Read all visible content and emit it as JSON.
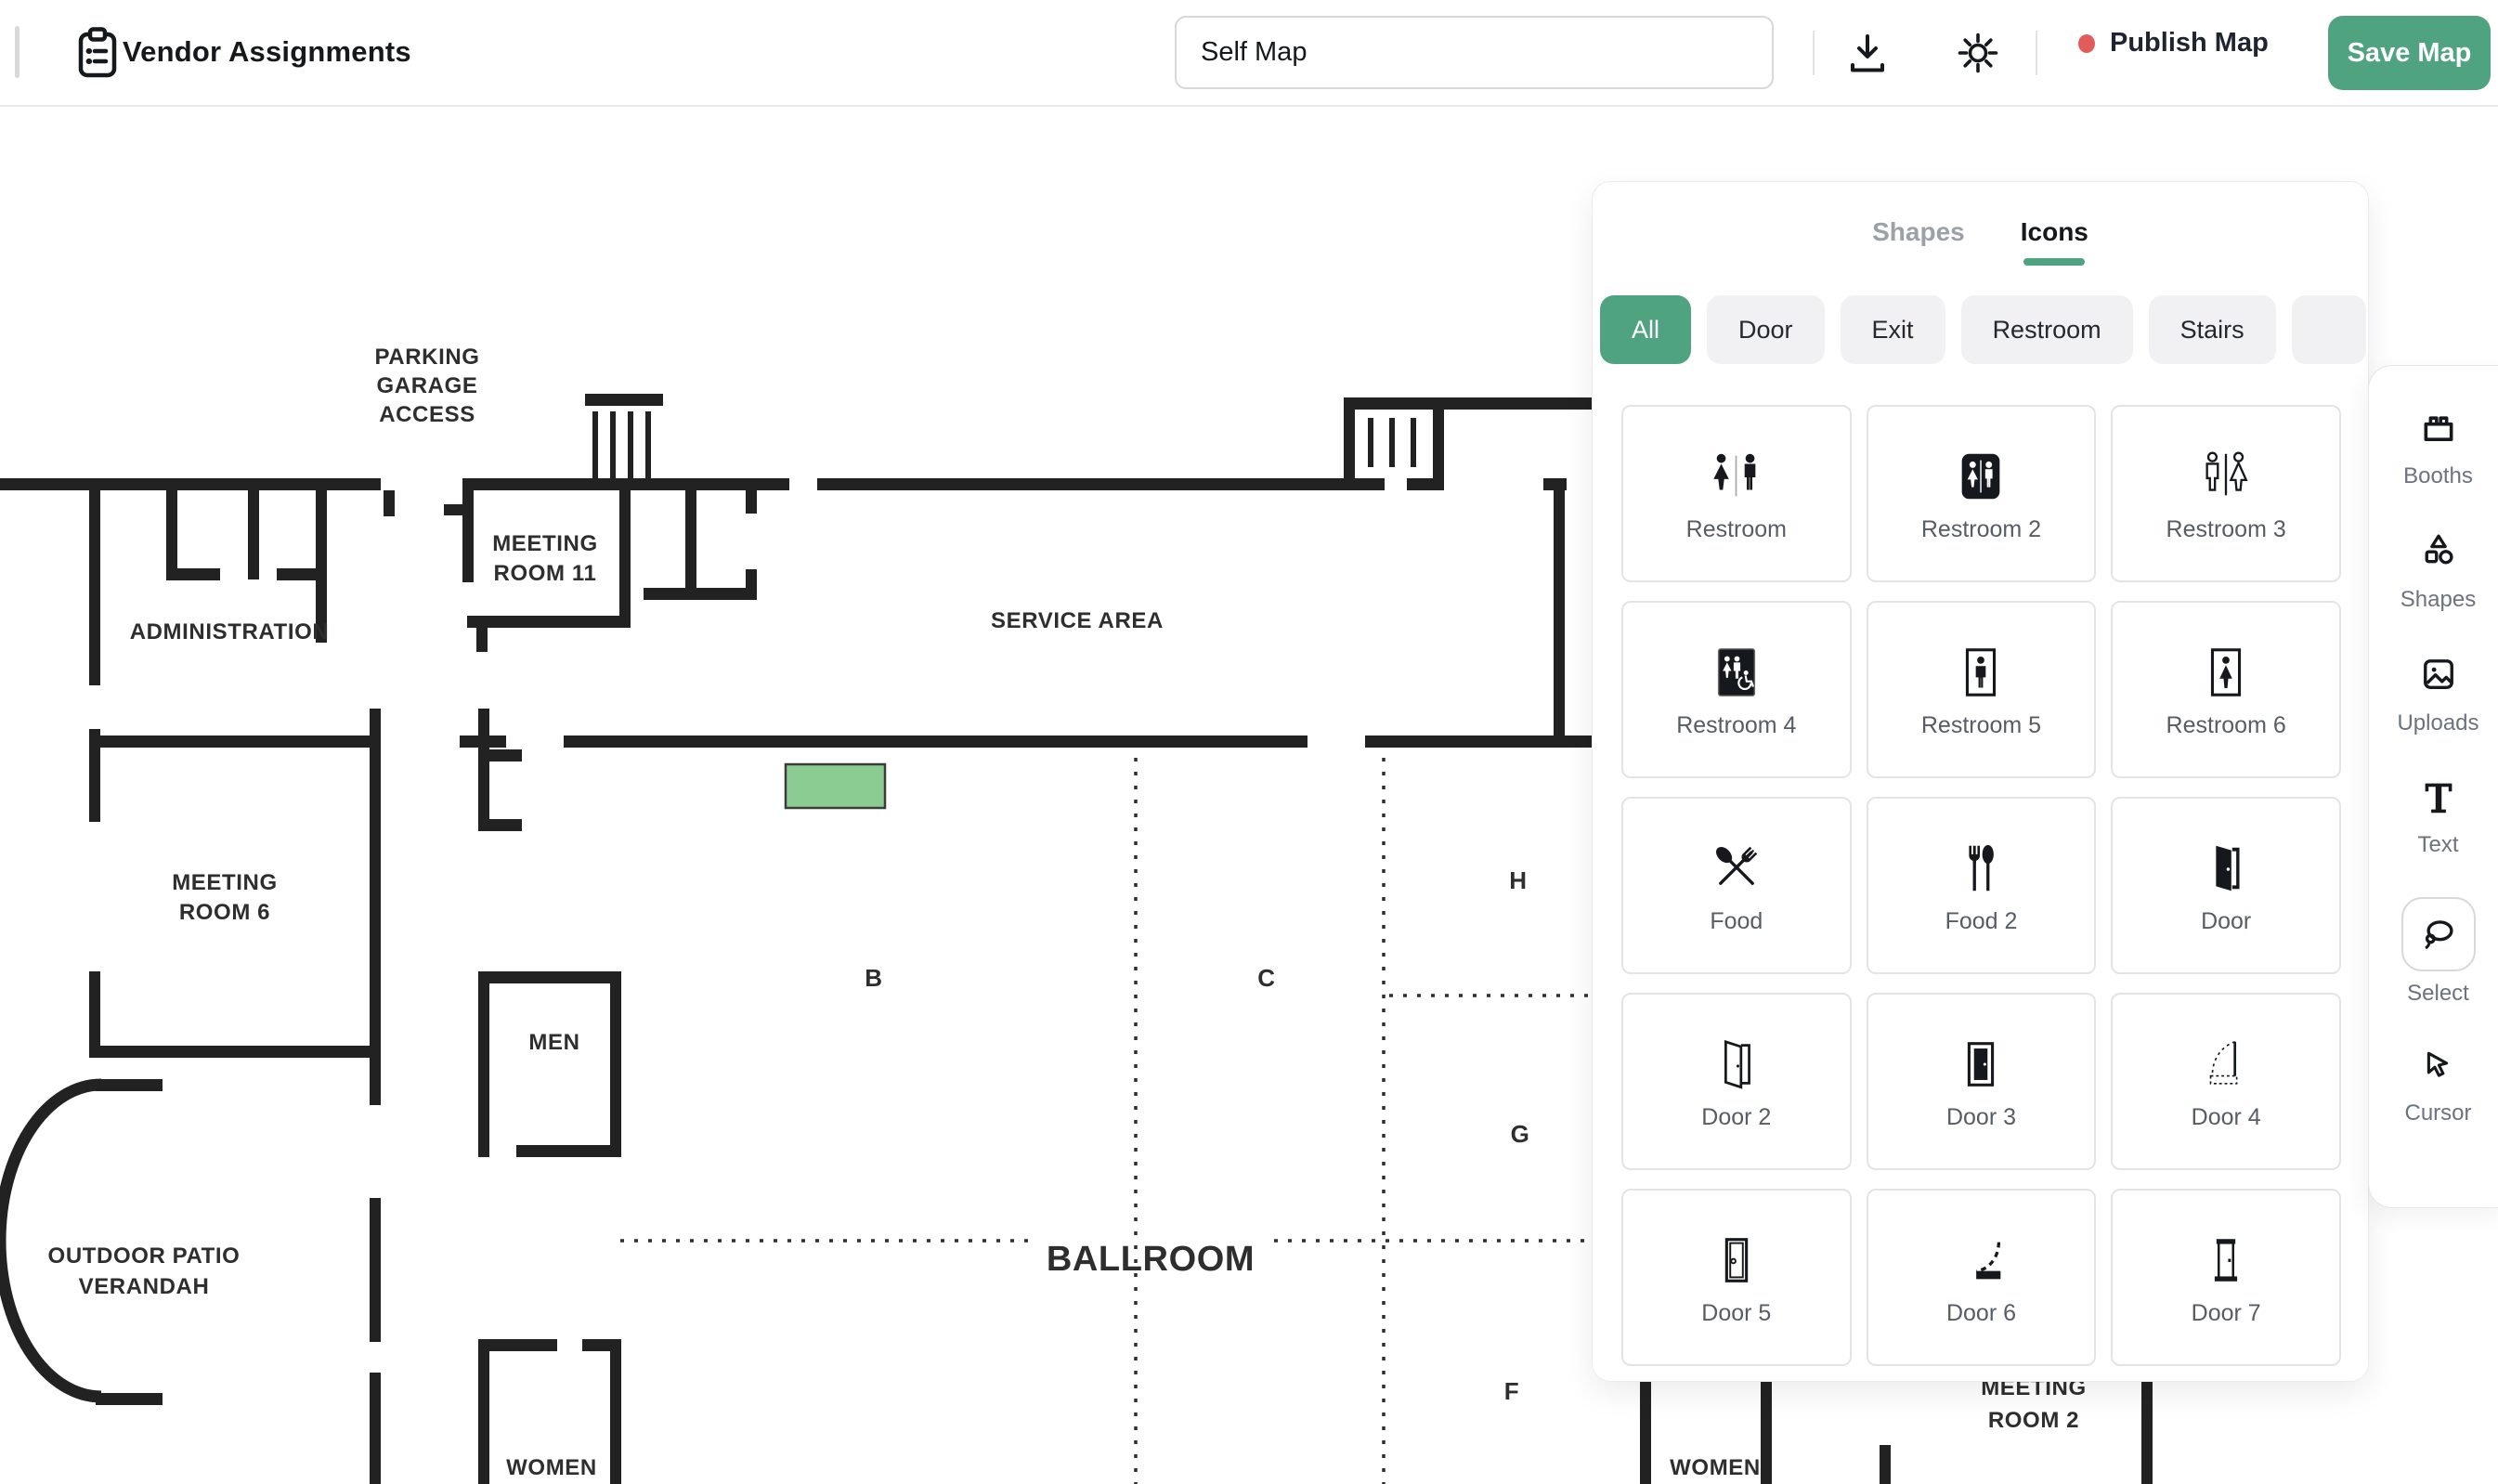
{
  "header": {
    "title": "Vendor Assignments",
    "map_name": "Self Map",
    "publish_label": "Publish Map",
    "save_label": "Save Map"
  },
  "panel": {
    "tabs": {
      "shapes": "Shapes",
      "icons": "Icons"
    },
    "active_tab": "Icons",
    "filters": [
      "All",
      "Door",
      "Exit",
      "Restroom",
      "Stairs"
    ],
    "active_filter": "All",
    "icons": [
      {
        "label": "Restroom"
      },
      {
        "label": "Restroom 2"
      },
      {
        "label": "Restroom 3"
      },
      {
        "label": "Restroom 4"
      },
      {
        "label": "Restroom 5"
      },
      {
        "label": "Restroom 6"
      },
      {
        "label": "Food"
      },
      {
        "label": "Food 2"
      },
      {
        "label": "Door"
      },
      {
        "label": "Door 2"
      },
      {
        "label": "Door 3"
      },
      {
        "label": "Door 4"
      },
      {
        "label": "Door 5"
      },
      {
        "label": "Door 6"
      },
      {
        "label": "Door 7"
      }
    ]
  },
  "toolbar": {
    "booths": "Booths",
    "shapes": "Shapes",
    "uploads": "Uploads",
    "text": "Text",
    "select": "Select",
    "cursor": "Cursor",
    "active_tool": "Select"
  },
  "plan": {
    "parking": [
      "PARKING",
      "GARAGE",
      "ACCESS"
    ],
    "meeting11": [
      "MEETING",
      "ROOM 11"
    ],
    "administration": "ADMINISTRATION",
    "service_area": "SERVICE AREA",
    "meeting6": [
      "MEETING",
      "ROOM 6"
    ],
    "men": "MEN",
    "outdoor": [
      "OUTDOOR PATIO",
      "VERANDAH"
    ],
    "ballroom": "BALLROOM",
    "women_left": "WOMEN",
    "women_right": "WOMEN",
    "meeting2": [
      "MEETING",
      "ROOM 2"
    ],
    "sections": [
      "B",
      "C",
      "H",
      "G",
      "F"
    ]
  },
  "colors": {
    "accent_green": "#4fa381",
    "booth_green": "#8bcc93",
    "publish_dot_red": "#e25c5c",
    "wall_black": "#222222"
  }
}
